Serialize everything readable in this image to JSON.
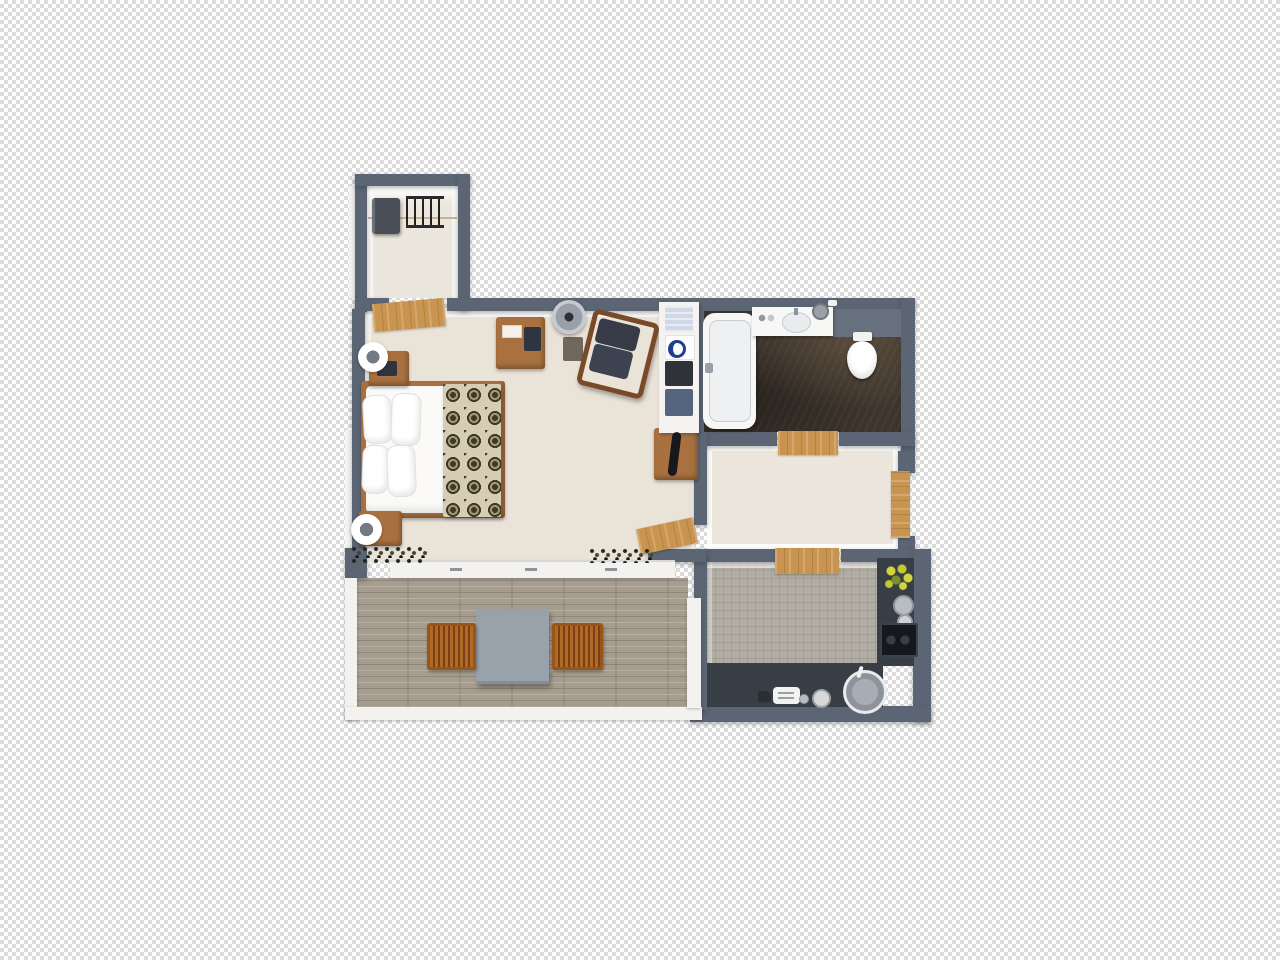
{
  "image_type": "3d-floor-plan-top-view-render",
  "background": {
    "style": "transparency-checkerboard",
    "checker_light": "#ffffff",
    "checker_dark": "#dcdcdc",
    "checker_square_px": 4
  },
  "palette": {
    "wall": "#5c6573",
    "wall_light": "#67707e",
    "floor_carpet": "#eae3d8",
    "floor_closet": "#ece7de",
    "floor_hall": "#ece6dc",
    "floor_bath_dark": "#3d352d",
    "floor_kitchen_tile": "#b2ada4",
    "deck_wood": "#a69d8e",
    "railing_white": "#f3f2ef",
    "door_wood": "#c9944f",
    "furniture_wood": "#a9713f",
    "counter_dark": "#383e45",
    "cushion_dark": "#363b47",
    "mattress_white": "#fbfaf8",
    "blanket_base": "#d6cdb2",
    "blanket_motif": "#3e392a",
    "table_gray": "#99a1ab",
    "chair_orange": "#a85e22",
    "shelf_white": "#f4f3f1",
    "basket_dark": "#2f3337",
    "basket_blue": "#54647e",
    "towel_blue": "#cfd8e4",
    "flower_yellow": "#d3d53e",
    "flower_green": "#7b8f2f",
    "fixture_white": "#f7f7f6"
  },
  "rooms": [
    {
      "id": "closet",
      "kind": "walk-in-closet",
      "floor": "light-carpet",
      "furniture": [
        "suitcase",
        "wall-coat-rack"
      ]
    },
    {
      "id": "bedroom",
      "kind": "bedroom",
      "floor": "beige-carpet",
      "furniture": [
        "double-bed",
        "four-pillows",
        "patterned-throw-blanket",
        "nightstand-upper",
        "nightstand-lower",
        "table-lamp-upper",
        "table-lamp-lower",
        "dresser",
        "floor-lamp",
        "armchair",
        "luggage-bench",
        "hair-dryer",
        "open-shelf-unit",
        "towels-and-baskets",
        "window-plants"
      ]
    },
    {
      "id": "bathroom",
      "kind": "bathroom",
      "floor": "dark-marble-tile",
      "furniture": [
        "bathtub",
        "washbasin-counter",
        "wall-hung-toilet",
        "waste-bin",
        "soap-dish"
      ]
    },
    {
      "id": "hallway",
      "kind": "entry-hall",
      "floor": "beige",
      "furniture": [
        "entry-door",
        "wood-thresholds"
      ]
    },
    {
      "id": "kitchen",
      "kind": "kitchen",
      "floor": "gray-square-tile",
      "furniture": [
        "l-shaped-counter",
        "cooktop",
        "round-sink",
        "toaster",
        "kettle",
        "bowls",
        "yellow-flower-pot"
      ]
    },
    {
      "id": "balcony",
      "kind": "balcony-terrace",
      "floor": "wood-plank-deck",
      "furniture": [
        "square-table",
        "wooden-chair-left",
        "wooden-chair-right",
        "white-railing",
        "sliding-glass-door"
      ]
    }
  ]
}
